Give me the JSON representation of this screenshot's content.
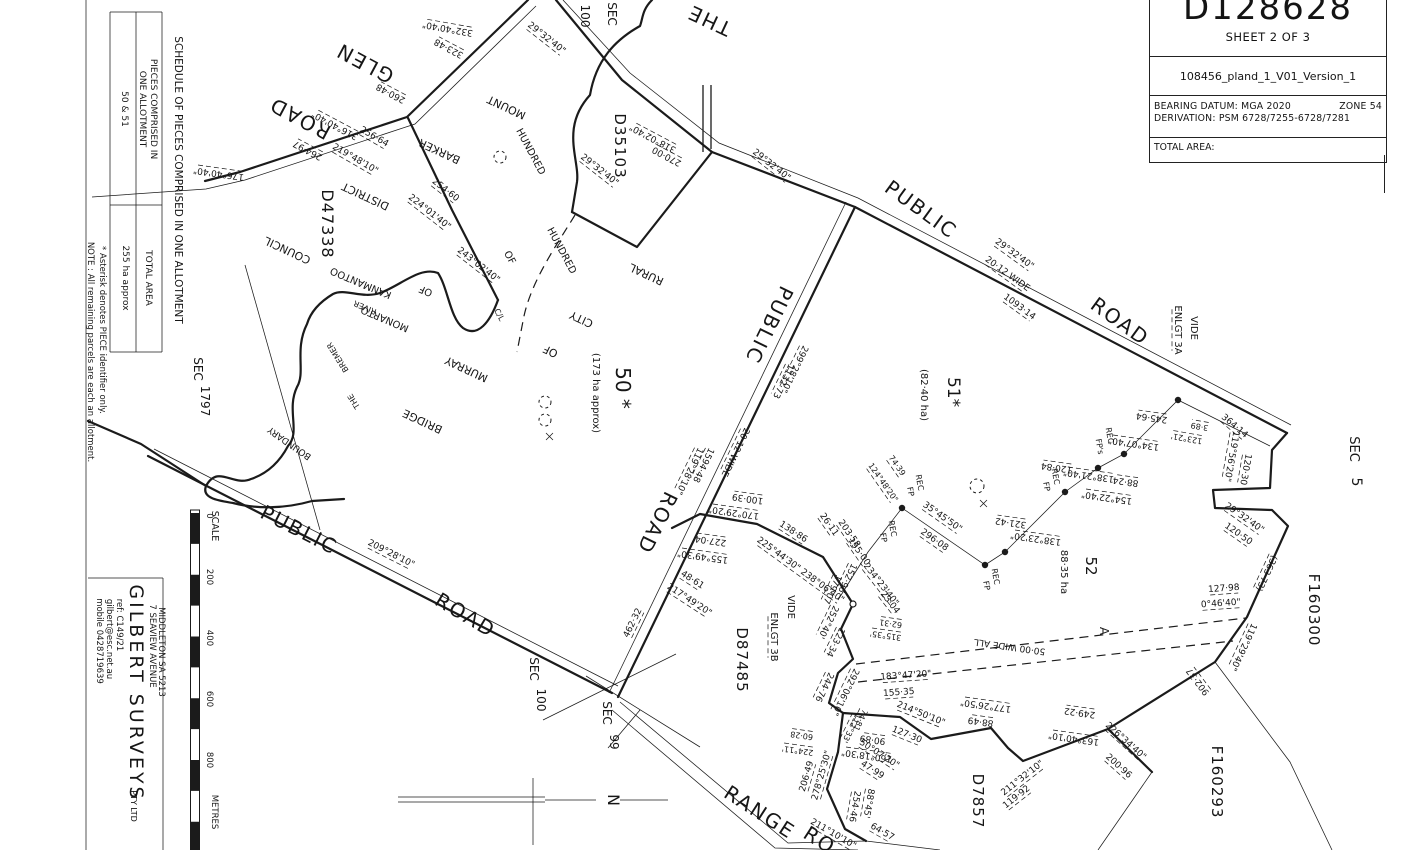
{
  "title_block": {
    "plan_number": "D128628",
    "sheet": "SHEET 2 OF 3",
    "file": "108456_pland_1_V01_Version_1",
    "datum": "BEARING DATUM: MGA 2020",
    "zone": "ZONE 54",
    "derivation": "DERIVATION: PSM 6728/7255-6728/7281",
    "total_area_label": "TOTAL AREA:"
  },
  "schedule": {
    "heading": "SCHEDULE OF PIECES COMPRISED IN ONE ALLOTMENT",
    "pieces_header_line1": "PIECES COMPRISED IN",
    "pieces_header_line2": "ONE ALLOTMENT",
    "pieces_value": "50 & 51",
    "total_area_header": "TOTAL AREA",
    "total_area_value": "255 ha approx",
    "note_asterisk": "* Asterisk denotes PIECE identifier only.",
    "note_remaining": "NOTE : All remaining parcels are each an allotment."
  },
  "surveyor": {
    "name": "GILBERT SURVEYS",
    "suffix": "PTY LTD",
    "mobile": "mobile 0428719639",
    "email": "gilbert@esc.net.au",
    "ref": "ref: C149/21",
    "address1": "7 SEAVIEW AVENUE",
    "address2": "MIDDLETON SA 5213"
  },
  "scale_bar": {
    "label": "SCALE",
    "ticks": [
      "0",
      "200",
      "400",
      "600",
      "800"
    ],
    "unit": "METRES"
  },
  "north_label": "N",
  "plan": {
    "labels": [
      {
        "t": "THE",
        "x": 712,
        "y": 14,
        "r": 205,
        "s": 20,
        "ls": 2
      },
      {
        "t": "GLEN",
        "x": 368,
        "y": 57,
        "r": 208,
        "s": 20,
        "ls": 2
      },
      {
        "t": "ROAD",
        "x": 303,
        "y": 112,
        "r": 208,
        "s": 20,
        "ls": 2
      },
      {
        "t": "332°40'40\"",
        "x": 448,
        "y": 26,
        "r": 190,
        "u": 1
      },
      {
        "t": "323·48",
        "x": 450,
        "y": 46,
        "r": 208,
        "u": 1
      },
      {
        "t": "260·48",
        "x": 392,
        "y": 91,
        "r": 208,
        "u": 1
      },
      {
        "t": "316°40'40\"",
        "x": 336,
        "y": 123,
        "r": 208,
        "u": 1
      },
      {
        "t": "264·97",
        "x": 309,
        "y": 148,
        "r": 208,
        "u": 1
      },
      {
        "t": "176°40'40\"",
        "x": 219,
        "y": 171,
        "r": 188,
        "u": 1
      },
      {
        "t": "256·64",
        "x": 373,
        "y": 139,
        "r": 30,
        "u": 1
      },
      {
        "t": "219°48'10\"",
        "x": 354,
        "y": 161,
        "r": 30,
        "u": 1
      },
      {
        "t": "254·60",
        "x": 444,
        "y": 192,
        "r": 38,
        "u": 1
      },
      {
        "t": "224°01'40\"",
        "x": 428,
        "y": 214,
        "r": 38,
        "u": 1
      },
      {
        "t": "243°02'40\"",
        "x": 477,
        "y": 267,
        "r": 38,
        "u": 1
      },
      {
        "t": "D47338",
        "x": 322,
        "y": 224,
        "r": 90,
        "s": 16,
        "ls": 1
      },
      {
        "t": "DISTRICT",
        "x": 367,
        "y": 193,
        "r": 205,
        "s": 11
      },
      {
        "t": "COUNCIL",
        "x": 289,
        "y": 247,
        "r": 205,
        "s": 11
      },
      {
        "t": "MOUNT",
        "x": 508,
        "y": 104,
        "r": 205,
        "s": 11
      },
      {
        "t": "BARKER",
        "x": 441,
        "y": 148,
        "r": 205,
        "s": 11
      },
      {
        "t": "HUNDRED",
        "x": 528,
        "y": 153,
        "r": 62,
        "s": 10
      },
      {
        "t": "HUNDRED",
        "x": 559,
        "y": 252,
        "r": 62,
        "s": 10
      },
      {
        "t": "OF",
        "x": 507,
        "y": 259,
        "r": 62,
        "s": 10
      },
      {
        "t": "KANMANTOO",
        "x": 362,
        "y": 280,
        "r": 203,
        "s": 10
      },
      {
        "t": "OF",
        "x": 427,
        "y": 288,
        "r": 203,
        "s": 10
      },
      {
        "t": "MONARTO",
        "x": 386,
        "y": 316,
        "r": 203,
        "s": 10
      },
      {
        "t": "RIVER",
        "x": 366,
        "y": 305,
        "r": 203,
        "s": 8
      },
      {
        "t": "BREMER",
        "x": 340,
        "y": 356,
        "r": 238,
        "s": 8
      },
      {
        "t": "THE",
        "x": 356,
        "y": 400,
        "r": 238,
        "s": 8
      },
      {
        "t": "C/L",
        "x": 497,
        "y": 316,
        "r": 62,
        "s": 8
      },
      {
        "t": "BOUNDARY",
        "x": 291,
        "y": 441,
        "r": 215,
        "s": 9
      },
      {
        "t": "SEC",
        "x": 194,
        "y": 369,
        "r": 90,
        "s": 12
      },
      {
        "t": "1797",
        "x": 201,
        "y": 401,
        "r": 90,
        "s": 12
      },
      {
        "t": "SEC",
        "x": 608,
        "y": 14,
        "r": 90,
        "s": 12
      },
      {
        "t": "100",
        "x": 581,
        "y": 16,
        "r": 90,
        "s": 12
      },
      {
        "t": "29°32'40\"",
        "x": 545,
        "y": 40,
        "r": 38,
        "u": 1
      },
      {
        "t": "D35103",
        "x": 615,
        "y": 146,
        "r": 90,
        "s": 15,
        "ls": 1
      },
      {
        "t": "29°32'40\"",
        "x": 598,
        "y": 172,
        "r": 38,
        "u": 1
      },
      {
        "t": "318°02'40\"",
        "x": 654,
        "y": 136,
        "r": 208,
        "u": 1
      },
      {
        "t": "270·00",
        "x": 668,
        "y": 154,
        "r": 208,
        "u": 1
      },
      {
        "t": "29°32'40\"",
        "x": 770,
        "y": 167,
        "r": 38,
        "u": 1
      },
      {
        "t": "PUBLIC",
        "x": 917,
        "y": 215,
        "r": 36,
        "s": 20,
        "ls": 2
      },
      {
        "t": "ROAD",
        "x": 1116,
        "y": 327,
        "r": 36,
        "s": 20,
        "ls": 2
      },
      {
        "t": "29°32'40\"",
        "x": 1013,
        "y": 256,
        "r": 36,
        "u": 1
      },
      {
        "t": "20·12 WIDE",
        "x": 1006,
        "y": 276,
        "r": 36,
        "u": 1
      },
      {
        "t": "1093·14",
        "x": 1018,
        "y": 309,
        "r": 36,
        "u": 1
      },
      {
        "t": "VIDE",
        "x": 1191,
        "y": 328,
        "r": 90,
        "s": 10
      },
      {
        "t": "ENLGT 3A",
        "x": 1175,
        "y": 330,
        "r": 90,
        "s": 10,
        "u": 1
      },
      {
        "t": "364·14",
        "x": 1233,
        "y": 428,
        "r": 40,
        "u": 1
      },
      {
        "t": "119°56'20\"",
        "x": 1229,
        "y": 456,
        "r": 100,
        "u": 1
      },
      {
        "t": "120·30",
        "x": 1243,
        "y": 469,
        "r": 100,
        "u": 1
      },
      {
        "t": "3·89",
        "x": 1200,
        "y": 424,
        "r": 190,
        "s": 8,
        "u": 1
      },
      {
        "t": "123°21'",
        "x": 1187,
        "y": 436,
        "r": 190,
        "s": 8,
        "u": 1
      },
      {
        "t": "245·64",
        "x": 1152,
        "y": 415,
        "r": 188,
        "u": 1
      },
      {
        "t": "134°07'40\"",
        "x": 1134,
        "y": 441,
        "r": 188,
        "u": 1
      },
      {
        "t": "REC",
        "x": 1107,
        "y": 436,
        "r": 80,
        "s": 8
      },
      {
        "t": "FP's",
        "x": 1097,
        "y": 447,
        "r": 80,
        "s": 8
      },
      {
        "t": "88·24",
        "x": 1126,
        "y": 479,
        "r": 188,
        "u": 1
      },
      {
        "t": "154°22'40\"",
        "x": 1107,
        "y": 495,
        "r": 188,
        "u": 1
      },
      {
        "t": "138°21'40\"",
        "x": 1089,
        "y": 473,
        "r": 188,
        "u": 1
      },
      {
        "t": "120·84",
        "x": 1057,
        "y": 465,
        "r": 188,
        "u": 1
      },
      {
        "t": "REC",
        "x": 1053,
        "y": 477,
        "r": 80,
        "s": 8
      },
      {
        "t": "FP",
        "x": 1044,
        "y": 487,
        "r": 80,
        "s": 8
      },
      {
        "t": "321·42",
        "x": 1011,
        "y": 520,
        "r": 188,
        "u": 1
      },
      {
        "t": "138°23'20\"",
        "x": 1036,
        "y": 536,
        "r": 188,
        "u": 1
      },
      {
        "t": "29°32'40\"",
        "x": 1243,
        "y": 520,
        "r": 35,
        "u": 1
      },
      {
        "t": "120·50",
        "x": 1237,
        "y": 536,
        "r": 35,
        "u": 1
      },
      {
        "t": "(363·73)",
        "x": 1264,
        "y": 572,
        "r": 115,
        "u": 1
      },
      {
        "t": "SEC",
        "x": 1350,
        "y": 449,
        "r": 90,
        "s": 13
      },
      {
        "t": "5",
        "x": 1352,
        "y": 482,
        "r": 90,
        "s": 14
      },
      {
        "t": "F160300",
        "x": 1309,
        "y": 610,
        "r": 90,
        "s": 15,
        "ls": 1
      },
      {
        "t": "127·98",
        "x": 1224,
        "y": 591,
        "r": -4,
        "u": 1
      },
      {
        "t": "0°46'40\"",
        "x": 1221,
        "y": 606,
        "r": -4,
        "u": 1
      },
      {
        "t": "119°29'40\"",
        "x": 1241,
        "y": 646,
        "r": 115,
        "u": 1
      },
      {
        "t": "902·37",
        "x": 1200,
        "y": 680,
        "r": 233,
        "u": 1
      },
      {
        "t": "F160293",
        "x": 1212,
        "y": 782,
        "r": 90,
        "s": 15,
        "ls": 1
      },
      {
        "t": "51*",
        "x": 948,
        "y": 392,
        "r": 90,
        "s": 17
      },
      {
        "t": "(82·40 ha)",
        "x": 921,
        "y": 395,
        "r": 90,
        "s": 10
      },
      {
        "t": "52",
        "x": 1086,
        "y": 566,
        "r": 90,
        "s": 15
      },
      {
        "t": "88·35 ha",
        "x": 1061,
        "y": 572,
        "r": 90,
        "s": 10
      },
      {
        "t": "35°45'50\"",
        "x": 941,
        "y": 519,
        "r": 35,
        "u": 1
      },
      {
        "t": "296·08",
        "x": 933,
        "y": 542,
        "r": 35,
        "u": 1
      },
      {
        "t": "REC",
        "x": 917,
        "y": 483,
        "r": 80,
        "s": 8
      },
      {
        "t": "FP",
        "x": 908,
        "y": 492,
        "r": 80,
        "s": 8
      },
      {
        "t": "REC",
        "x": 890,
        "y": 529,
        "r": 80,
        "s": 8
      },
      {
        "t": "FP",
        "x": 881,
        "y": 538,
        "r": 80,
        "s": 8
      },
      {
        "t": "REC",
        "x": 993,
        "y": 577,
        "r": 80,
        "s": 8
      },
      {
        "t": "FP",
        "x": 984,
        "y": 586,
        "r": 80,
        "s": 8
      },
      {
        "t": "74·39",
        "x": 895,
        "y": 467,
        "r": 55,
        "s": 8,
        "u": 1
      },
      {
        "t": "124°48'20\"",
        "x": 881,
        "y": 484,
        "r": 55,
        "s": 8,
        "u": 1
      },
      {
        "t": "234°23'40\"",
        "x": 879,
        "y": 586,
        "r": 52,
        "u": 1
      },
      {
        "t": "23·04",
        "x": 888,
        "y": 604,
        "r": 52,
        "u": 1
      },
      {
        "t": "62·31",
        "x": 891,
        "y": 621,
        "r": 188,
        "s": 8,
        "u": 1
      },
      {
        "t": "315°35'",
        "x": 886,
        "y": 633,
        "r": 188,
        "s": 8,
        "u": 1
      },
      {
        "t": "PUBLIC",
        "x": 763,
        "y": 322,
        "r": 116,
        "s": 20,
        "ls": 2
      },
      {
        "t": "ROAD",
        "x": 651,
        "y": 520,
        "r": 116,
        "s": 20,
        "ls": 2
      },
      {
        "t": "299°28'10\"",
        "x": 792,
        "y": 368,
        "r": 116,
        "u": 1
      },
      {
        "t": "1132·73",
        "x": 781,
        "y": 380,
        "r": 116,
        "u": 1
      },
      {
        "t": "20·12 WIDE",
        "x": 733,
        "y": 451,
        "r": 116,
        "u": 1
      },
      {
        "t": "1594·48",
        "x": 701,
        "y": 464,
        "r": 116,
        "u": 1
      },
      {
        "t": "119°28'10\"",
        "x": 687,
        "y": 470,
        "r": 116,
        "u": 1
      },
      {
        "t": "50 *",
        "x": 616,
        "y": 388,
        "r": 90,
        "s": 20
      },
      {
        "t": "(173 ha approx)",
        "x": 593,
        "y": 393,
        "r": 90,
        "s": 10
      },
      {
        "t": "RURAL",
        "x": 648,
        "y": 271,
        "r": 205,
        "s": 11
      },
      {
        "t": "CITY",
        "x": 583,
        "y": 316,
        "r": 205,
        "s": 11
      },
      {
        "t": "OF",
        "x": 552,
        "y": 348,
        "r": 205,
        "s": 11
      },
      {
        "t": "MURRAY",
        "x": 468,
        "y": 366,
        "r": 205,
        "s": 11
      },
      {
        "t": "BRIDGE",
        "x": 424,
        "y": 418,
        "r": 205,
        "s": 11
      },
      {
        "t": "462·32",
        "x": 635,
        "y": 624,
        "r": 296,
        "u": 1
      },
      {
        "t": "209°28'10\"",
        "x": 390,
        "y": 556,
        "r": 27,
        "u": 1
      },
      {
        "t": "PUBLIC",
        "x": 296,
        "y": 536,
        "r": 27,
        "s": 20,
        "ls": 2
      },
      {
        "t": "ROAD",
        "x": 462,
        "y": 621,
        "r": 31,
        "s": 20,
        "ls": 2
      },
      {
        "t": "SEC",
        "x": 530,
        "y": 669,
        "r": 90,
        "s": 12
      },
      {
        "t": "100",
        "x": 537,
        "y": 700,
        "r": 90,
        "s": 12
      },
      {
        "t": "SEC",
        "x": 603,
        "y": 713,
        "r": 90,
        "s": 12
      },
      {
        "t": "99",
        "x": 610,
        "y": 742,
        "r": 90,
        "s": 12
      },
      {
        "t": "100·39",
        "x": 748,
        "y": 496,
        "r": 188,
        "u": 1
      },
      {
        "t": "170°29'20\"",
        "x": 734,
        "y": 510,
        "r": 188,
        "u": 1
      },
      {
        "t": "138·86",
        "x": 792,
        "y": 534,
        "r": 33,
        "u": 1
      },
      {
        "t": "225°44'30\" 238°06'40\"",
        "x": 799,
        "y": 572,
        "r": 36,
        "u": 1
      },
      {
        "t": "227·04",
        "x": 711,
        "y": 538,
        "r": 188,
        "u": 1
      },
      {
        "t": "155°49'30\"",
        "x": 703,
        "y": 554,
        "r": 188,
        "u": 1
      },
      {
        "t": "48·61",
        "x": 691,
        "y": 582,
        "r": 33,
        "u": 1
      },
      {
        "t": "217°49'20\"",
        "x": 688,
        "y": 602,
        "r": 33,
        "u": 1
      },
      {
        "t": "26·11",
        "x": 827,
        "y": 526,
        "r": 55,
        "u": 1
      },
      {
        "t": "203·58",
        "x": 847,
        "y": 535,
        "r": 55,
        "u": 1
      },
      {
        "t": "155·00",
        "x": 857,
        "y": 553,
        "r": 55,
        "u": 1
      },
      {
        "t": "152·96",
        "x": 845,
        "y": 577,
        "r": 116,
        "u": 1
      },
      {
        "t": "179·07",
        "x": 830,
        "y": 588,
        "r": 116,
        "u": 1
      },
      {
        "t": "VIDE",
        "x": 788,
        "y": 607,
        "r": 90,
        "s": 10
      },
      {
        "t": "ENLGT 3B",
        "x": 771,
        "y": 637,
        "r": 90,
        "s": 10,
        "u": 1
      },
      {
        "t": "D87485",
        "x": 737,
        "y": 660,
        "r": 90,
        "s": 15,
        "ls": 1
      },
      {
        "t": "252°40'",
        "x": 826,
        "y": 621,
        "r": 116,
        "u": 1
      },
      {
        "t": "123·34",
        "x": 833,
        "y": 641,
        "r": 116,
        "u": 1
      },
      {
        "t": "292°06'10\"",
        "x": 843,
        "y": 691,
        "r": 116,
        "u": 1
      },
      {
        "t": "244·76",
        "x": 822,
        "y": 686,
        "r": 116,
        "u": 1
      },
      {
        "t": "224°11'",
        "x": 798,
        "y": 748,
        "r": 188,
        "s": 8,
        "u": 1
      },
      {
        "t": "60·28",
        "x": 802,
        "y": 733,
        "r": 188,
        "s": 8,
        "u": 1
      },
      {
        "t": "278°25'30\"",
        "x": 824,
        "y": 776,
        "r": 286,
        "u": 1
      },
      {
        "t": "206·49",
        "x": 809,
        "y": 777,
        "r": 286,
        "u": 1
      },
      {
        "t": "112°33'",
        "x": 849,
        "y": 727,
        "r": 116,
        "s": 8,
        "u": 1
      },
      {
        "t": "74·81",
        "x": 858,
        "y": 719,
        "r": 116,
        "s": 8,
        "u": 1
      },
      {
        "t": "254·46",
        "x": 852,
        "y": 806,
        "r": 100,
        "u": 1
      },
      {
        "t": "88°45'",
        "x": 866,
        "y": 803,
        "r": 100,
        "u": 1
      },
      {
        "t": "64·57",
        "x": 881,
        "y": 834,
        "r": 30,
        "u": 1
      },
      {
        "t": "211°10'10\"",
        "x": 832,
        "y": 836,
        "r": 30,
        "u": 1
      },
      {
        "t": "50°07'20\"",
        "x": 878,
        "y": 756,
        "r": 33,
        "u": 1
      },
      {
        "t": "47·99",
        "x": 871,
        "y": 772,
        "r": 33,
        "u": 1
      },
      {
        "t": "214°50'10\"",
        "x": 920,
        "y": 716,
        "r": 22,
        "u": 1
      },
      {
        "t": "127·30",
        "x": 906,
        "y": 737,
        "r": 22,
        "u": 1
      },
      {
        "t": "183°47'20\"",
        "x": 906,
        "y": 678,
        "r": -4,
        "u": 1
      },
      {
        "t": "155·35",
        "x": 899,
        "y": 695,
        "r": -4,
        "u": 1
      },
      {
        "t": "177°26'50\"",
        "x": 986,
        "y": 703,
        "r": 188,
        "u": 1
      },
      {
        "t": "88·49",
        "x": 981,
        "y": 719,
        "r": 188,
        "u": 1
      },
      {
        "t": "90·89",
        "x": 873,
        "y": 737,
        "r": 188,
        "u": 1
      },
      {
        "t": "160°18'30\"",
        "x": 867,
        "y": 753,
        "r": 188,
        "u": 1
      },
      {
        "t": "211°32'10\"",
        "x": 1024,
        "y": 780,
        "r": -38,
        "u": 1
      },
      {
        "t": "119·92",
        "x": 1018,
        "y": 799,
        "r": -38,
        "u": 1
      },
      {
        "t": "D7857",
        "x": 973,
        "y": 801,
        "r": 90,
        "s": 15,
        "ls": 1
      },
      {
        "t": "RANGE",
        "x": 756,
        "y": 818,
        "r": 33,
        "s": 20,
        "ls": 2
      },
      {
        "t": "RO",
        "x": 816,
        "y": 846,
        "r": 33,
        "s": 20,
        "ls": 2
      },
      {
        "t": "50·00 WIDE ALL",
        "x": 1010,
        "y": 644,
        "r": 188
      },
      {
        "t": "A",
        "x": 1100,
        "y": 631,
        "r": 90,
        "s": 12
      },
      {
        "t": "249·22",
        "x": 1080,
        "y": 710,
        "r": 188,
        "u": 1
      },
      {
        "t": "163°40'10\"",
        "x": 1074,
        "y": 736,
        "r": 188,
        "u": 1
      },
      {
        "t": "226°34'40\"",
        "x": 1124,
        "y": 743,
        "r": 42,
        "u": 1
      },
      {
        "t": "200·96",
        "x": 1117,
        "y": 768,
        "r": 42,
        "u": 1
      }
    ]
  }
}
